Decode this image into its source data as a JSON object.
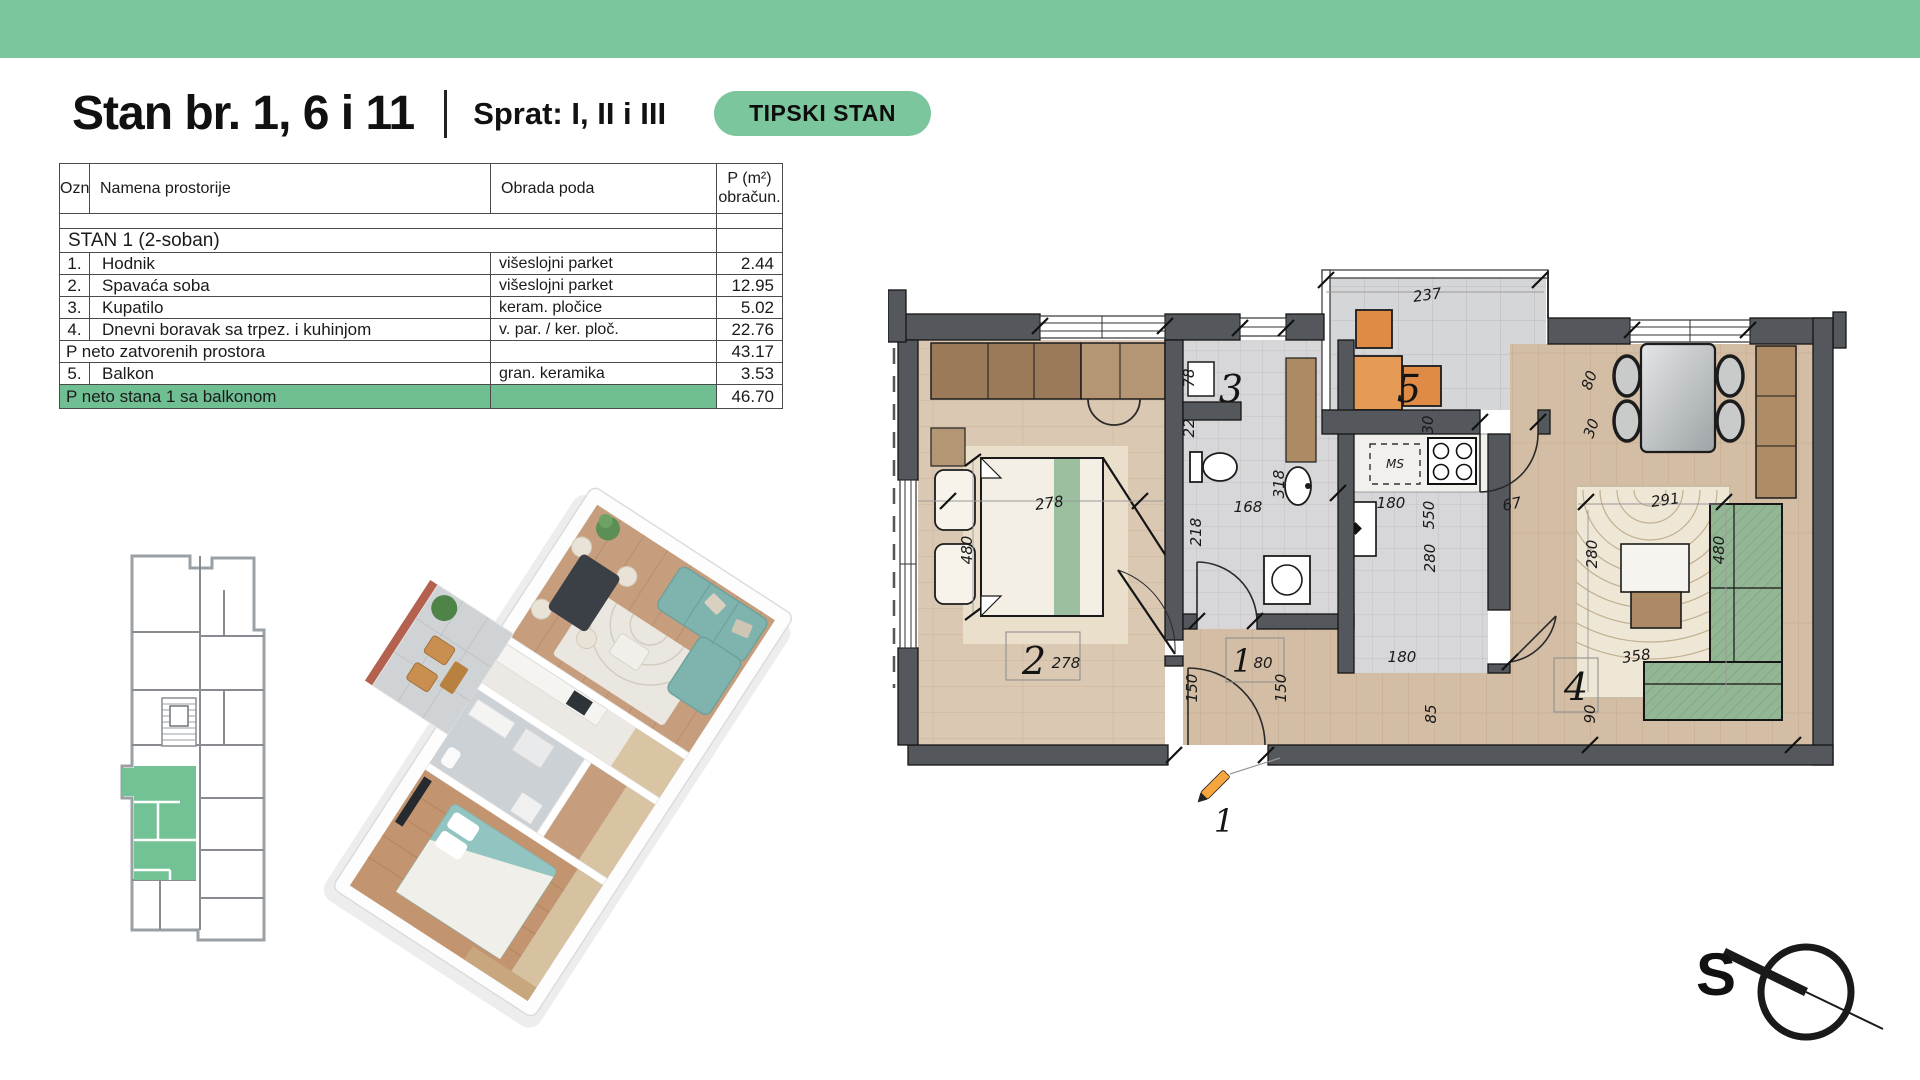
{
  "meta": {
    "accent_green": "#7cc69e",
    "table_total_green": "#6fbf93",
    "keyplan_green": "#72c296"
  },
  "header": {
    "title": "Stan br. 1, 6 i 11",
    "subtitle": "Sprat: I, II i III",
    "badge": "TIPSKI STAN"
  },
  "table": {
    "col_ozn": "Ozn.",
    "col_name": "Namena prostorije",
    "col_floor": "Obrada poda",
    "col_area_1": "P (m²)",
    "col_area_2": "obračun.",
    "section": "STAN 1  (2-soban)",
    "rows": [
      {
        "ozn": "1.",
        "name": "Hodnik",
        "floor": "višeslojni parket",
        "area": "2.44"
      },
      {
        "ozn": "2.",
        "name": "Spavaća soba",
        "floor": "višeslojni parket",
        "area": "12.95"
      },
      {
        "ozn": "3.",
        "name": "Kupatilo",
        "floor": "keram. pločice",
        "area": "5.02"
      },
      {
        "ozn": "4.",
        "name": "Dnevni boravak sa trpez. i kuhinjom",
        "floor": "v. par. / ker. ploč.",
        "area": "22.76"
      }
    ],
    "subtotal_label": "P neto zatvorenih prostora",
    "subtotal_area": "43.17",
    "balcony_row": {
      "ozn": "5.",
      "name": "Balkon",
      "floor": "gran. keramika",
      "area": "3.53"
    },
    "total_label": "P neto stana 1 sa balkonom",
    "total_area": "46.70"
  },
  "plan": {
    "rooms": {
      "hall": "1",
      "bedroom": "2",
      "bath": "3",
      "living": "4",
      "balcony": "5"
    },
    "dims": {
      "balcony_width": "237",
      "balcony_wall": "30",
      "dining_a": "80",
      "dining_b": "30",
      "bath_shelf": "78",
      "bath_jog": "22",
      "bath_depth": "218",
      "bath_width": "168",
      "bath_sink": "318",
      "ms": "MS",
      "kitchen_width": "180",
      "kitchen_depth": "550",
      "kitchen_lower": "280",
      "living_gap": "67",
      "rug_width": "291",
      "rug_depth": "280",
      "sofa_len": "480",
      "sofa_width": "358",
      "sofa_gap": "90",
      "bed_width": "278",
      "bed_len": "480",
      "bedroom_label_dim": "278",
      "hall_dim": "80",
      "hall_a": "150",
      "hall_b": "150",
      "hall_len": "180",
      "hall_gap": "85"
    },
    "entrance_label": "1"
  },
  "compass": {
    "label": "S"
  }
}
